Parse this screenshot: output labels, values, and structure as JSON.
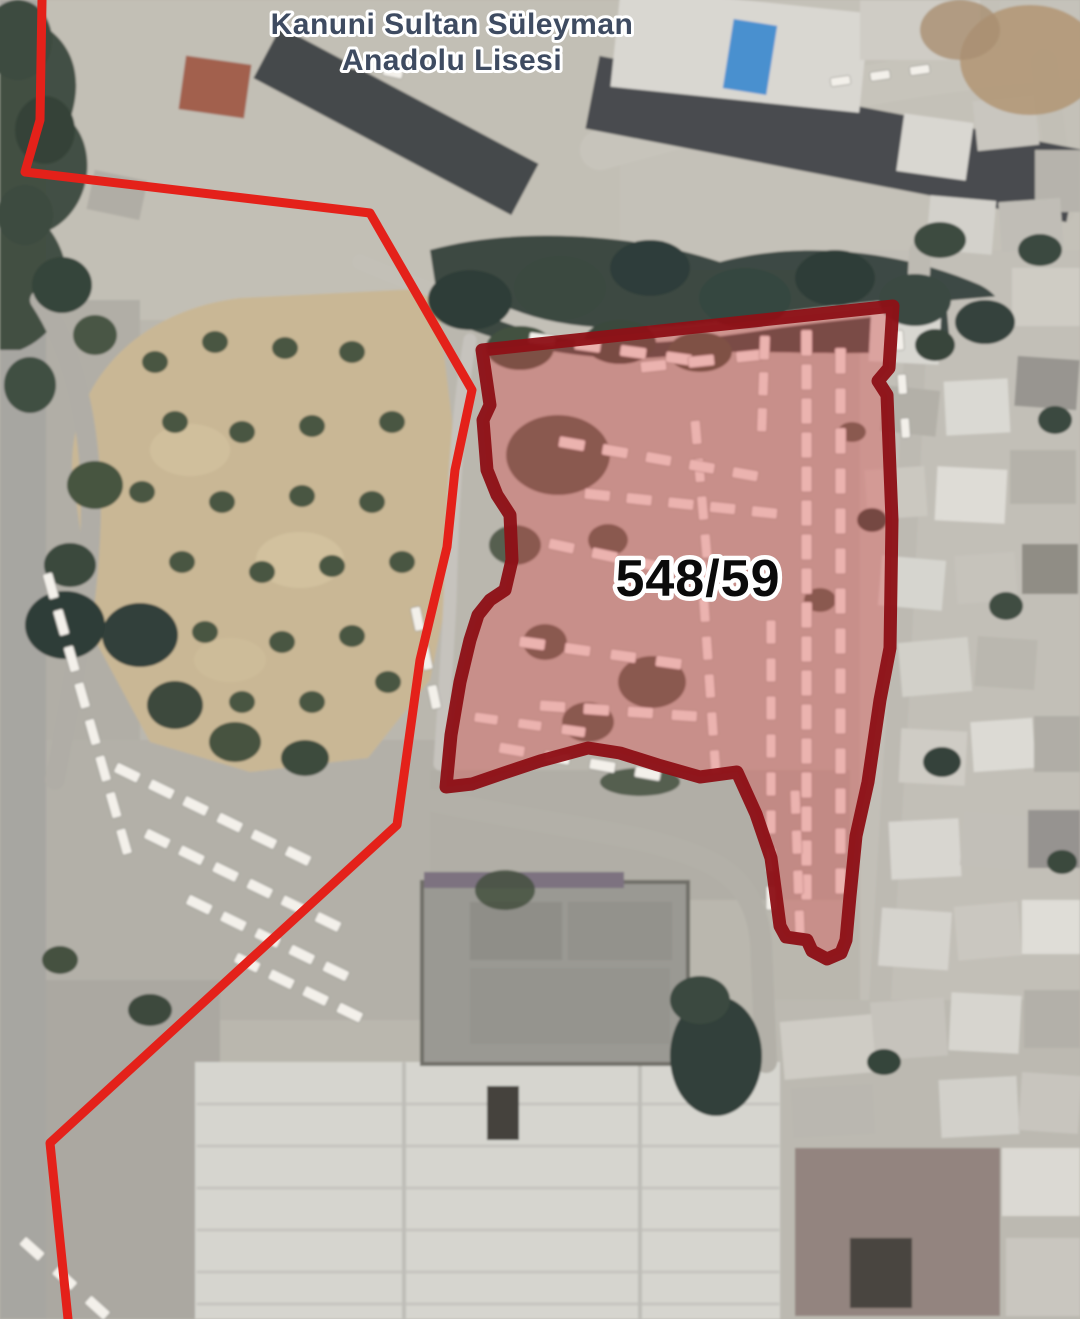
{
  "map": {
    "school_label": {
      "line1": "Kanuni Sultan Süleyman",
      "line2": "Anadolu Lisesi"
    },
    "parcel": {
      "number": "548/59",
      "polygon_points": "482,350 893,306 889,368 878,381 887,395 892,520 890,648 880,700 868,782 856,836 850,896 846,940 841,953 827,959 812,951 807,940 786,937 780,926 777,903 771,858 756,814 737,772 700,777 658,765 620,753 588,748 540,761 504,773 472,784 446,787 451,735 460,682 470,640 478,615 490,600 505,590 512,560 510,515 497,495 487,470 483,420 490,405"
    },
    "boundary": {
      "main_points": "42,0 40,120 25,172 370,213 472,390 455,470 447,547 420,660 397,825 50,1143 68,1319"
    },
    "colors": {
      "boundary_red": "#e4211a",
      "parcel_outline": "#8e1117",
      "parcel_fill": "#e05050",
      "school_label": "#3e4b61",
      "parcel_label": "#0a0a0a"
    }
  }
}
